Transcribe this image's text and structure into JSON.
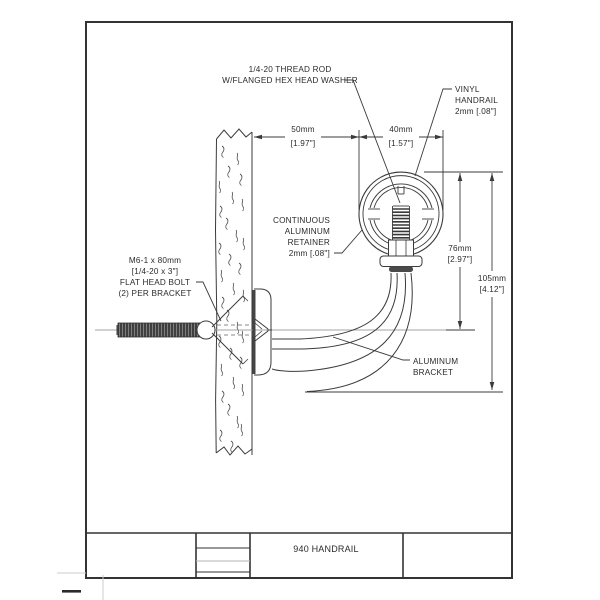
{
  "sheet": {
    "labels": {
      "thread_rod": {
        "l1": "1/4-20 THREAD ROD",
        "l2": "W/FLANGED HEX HEAD WASHER"
      },
      "vinyl": {
        "l1": "VINYL",
        "l2": "HANDRAIL",
        "l3": "2mm [.08\"]"
      },
      "retainer": {
        "l1": "CONTINUOUS",
        "l2": "ALUMINUM",
        "l3": "RETAINER",
        "l4": "2mm [.08\"]"
      },
      "bolt": {
        "l1": "M6-1 x 80mm",
        "l2": "[1/4-20 x 3\"]",
        "l3": "FLAT HEAD BOLT",
        "l4": "(2) PER BRACKET"
      },
      "bracket": {
        "l1": "ALUMINUM",
        "l2": "BRACKET"
      }
    },
    "dimensions": {
      "d50": {
        "mm": "50mm",
        "in": "[1.97\"]"
      },
      "d40": {
        "mm": "40mm",
        "in": "[1.57\"]"
      },
      "d76": {
        "mm": "76mm",
        "in": "[2.97\"]"
      },
      "d105": {
        "mm": "105mm",
        "in": "[4.12\"]"
      }
    },
    "title_block": {
      "title": "940 HANDRAIL"
    },
    "colors": {
      "line": "#3b3b3b",
      "centerline": "#a3a3a3",
      "text": "#2b2b2b",
      "background": "#ffffff"
    }
  }
}
